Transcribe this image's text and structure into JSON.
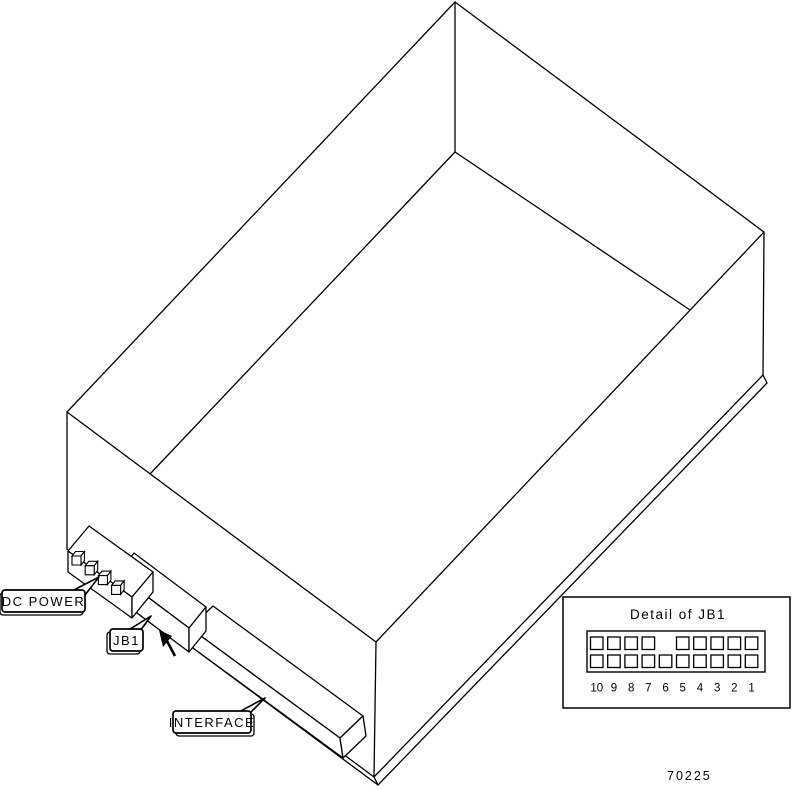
{
  "figure_number": "70225",
  "drawing": {
    "subject": "disk-drive-isometric-view",
    "callouts": {
      "dc_power": "DC POWER",
      "jb1": "JB1",
      "interface": "INTERFACE"
    }
  },
  "detail_inset": {
    "title": "Detail of JB1",
    "columns": [
      "10",
      "9",
      "8",
      "7",
      "6",
      "5",
      "4",
      "3",
      "2",
      "1"
    ],
    "top_row_present": [
      true,
      true,
      true,
      true,
      false,
      true,
      true,
      true,
      true,
      true
    ],
    "bottom_row_present": [
      true,
      true,
      true,
      true,
      true,
      true,
      true,
      true,
      true,
      true
    ]
  },
  "colors": {
    "line": "#000000",
    "background": "#ffffff"
  }
}
